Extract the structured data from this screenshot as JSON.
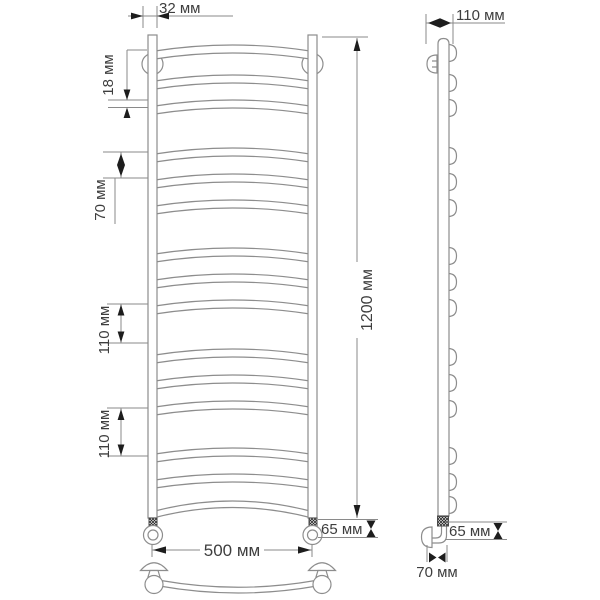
{
  "unit": "мм",
  "labels": {
    "d32": "32 мм",
    "d18": "18 мм",
    "d70_left": "70 мм",
    "d110_a": "110 мм",
    "d110_b": "110 мм",
    "d1200": "1200 мм",
    "d500": "500 мм",
    "d65_left": "65 мм",
    "d110_top": "110 мм",
    "d65_right": "65 мм",
    "d70_bottom": "70 мм"
  },
  "dimension_values_mm": [
    32,
    18,
    70,
    110,
    110,
    1200,
    500,
    65,
    110,
    65,
    70
  ],
  "drawing": {
    "rung_centers": [
      49,
      79,
      104,
      152,
      178,
      204,
      252,
      278,
      304,
      353,
      379,
      405,
      452,
      478
    ],
    "side_bump_centers": [
      53,
      83,
      108,
      156,
      182,
      208,
      256,
      282,
      308,
      357,
      383,
      409,
      456,
      482,
      505
    ],
    "colors": {
      "background": "#ffffff",
      "line": "#8d8d8d",
      "text": "#3e3e3e",
      "arrow": "#1d1d1d"
    }
  }
}
